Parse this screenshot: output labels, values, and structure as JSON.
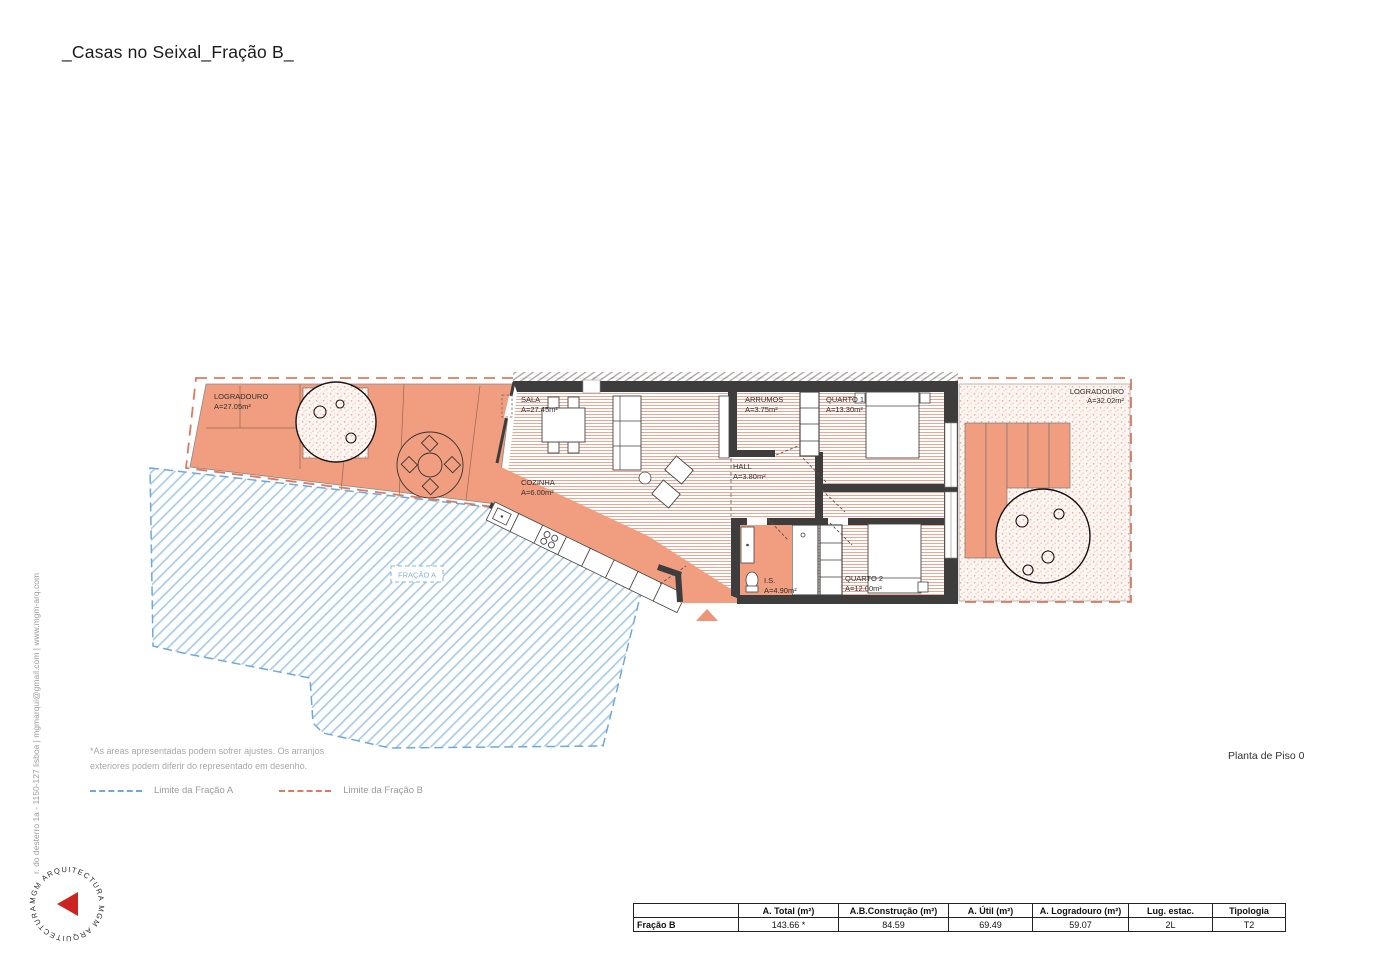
{
  "title": "_Casas no Seixal_Fração B_",
  "side": {
    "contact": "r. do desterro 1a - 1150-127 lisboa | mgmarqui@gmail.com | www.mgm-arq.com",
    "logo_text": "MGM ARQUITECTURA MGM ARQUITECTURA"
  },
  "plan": {
    "logradouro_left": {
      "name": "LOGRADOURO",
      "area": "A=27.05m²"
    },
    "sala": {
      "name": "SALA",
      "area": "A=27.45m²"
    },
    "cozinha": {
      "name": "COZINHA",
      "area": "A=6.00m²"
    },
    "arrumos": {
      "name": "ARRUMOS",
      "area": "A=3.75m²"
    },
    "quarto1": {
      "name": "QUARTO 1",
      "area": "A=13.30m²"
    },
    "hall": {
      "name": "HALL",
      "area": "A=3.80m²"
    },
    "is": {
      "name": "I.S.",
      "area": "A=4.90m²"
    },
    "quarto2": {
      "name": "QUARTO 2",
      "area": "A=12.00m²"
    },
    "logradouro_right": {
      "name": "LOGRADOURO",
      "area": "A=32.02m²"
    },
    "fracao_a": "FRAÇÃO A"
  },
  "notes": {
    "line1": "*As áreas apresentadas podem sofrer ajustes. Os arranjos",
    "line2": "exteriores podem diferir do representado em desenho."
  },
  "legend": {
    "a_label": "Limite da Fração A",
    "b_label": "Limite da Fração B",
    "a_color": "#6fa8dc",
    "b_color": "#e0795c"
  },
  "drawing_title": "Planta de Piso 0",
  "table": {
    "headers": [
      "",
      "A. Total (m²)",
      "A.B.Construção (m²)",
      "A. Útil (m²)",
      "A. Logradouro (m²)",
      "Lug. estac.",
      "Tipologia"
    ],
    "row_label": "Fração B",
    "values": [
      "143.66 *",
      "84.59",
      "69.49",
      "59.07",
      "2L",
      "T2"
    ]
  },
  "colors": {
    "salmon_fill": "#f19e80",
    "wall": "#3d3d3d",
    "floor_hatch": "#eba694",
    "blue_hatch": "#a9cce8"
  }
}
